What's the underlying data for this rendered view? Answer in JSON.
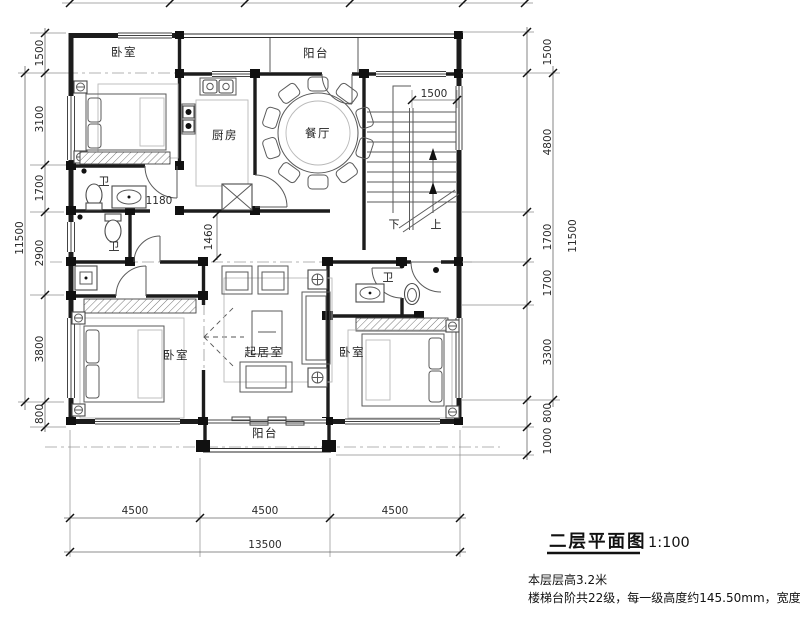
{
  "drawing": {
    "title": "二层平面图",
    "scale": "1:100",
    "note1": "本层层高3.2米",
    "note2": "楼梯台阶共22级，每一级高度约145.50mm，宽度260mm"
  },
  "rooms": {
    "bedroom_top": "卧室",
    "balcony_top": "阳台",
    "kitchen": "厨房",
    "dining": "餐厅",
    "bath_ensuite": "卫",
    "bath_shared": "卫",
    "bath_right": "卫",
    "bedroom_left": "卧室",
    "living": "起居室",
    "bedroom_right": "卧室",
    "balcony_bottom": "阳台"
  },
  "stairs": {
    "down_label": "下",
    "up_label": "上",
    "width": "1500"
  },
  "dimensions": {
    "left": [
      "1500",
      "3100",
      "1700",
      "2900",
      "3800",
      "800"
    ],
    "left_total": "11500",
    "right": [
      "1500",
      "4800",
      "1700",
      "1700",
      "3300",
      "800",
      "1000"
    ],
    "right_total": "11500",
    "bottom": [
      "4500",
      "4500",
      "4500"
    ],
    "bottom_total": "13500",
    "door_width": "1180",
    "hall_width": "1460"
  }
}
